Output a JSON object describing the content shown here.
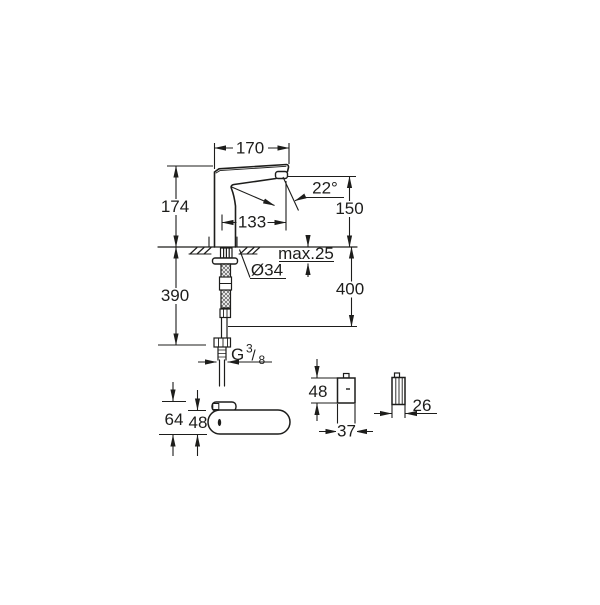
{
  "drawing": {
    "type": "faucet-dimensional-technical-drawing",
    "background_color": "#ffffff",
    "line_color": "#1d1d1b",
    "labels": {
      "spout_width": "170",
      "body_height": "174",
      "outlet_height": "150",
      "stream_angle": "22°",
      "outlet_projection": "133",
      "max_deck_thickness": "max.25",
      "hole_diameter": "Ø34",
      "length_below_deck": "390",
      "hose_length": "400",
      "thread_letter": "G",
      "thread_numerator": "3",
      "thread_slash": "/",
      "thread_denominator": "8",
      "top_view_total_depth": "64",
      "top_view_body_depth": "48",
      "control_box_height": "48",
      "control_box_width": "37",
      "control_box_depth": "26"
    }
  }
}
